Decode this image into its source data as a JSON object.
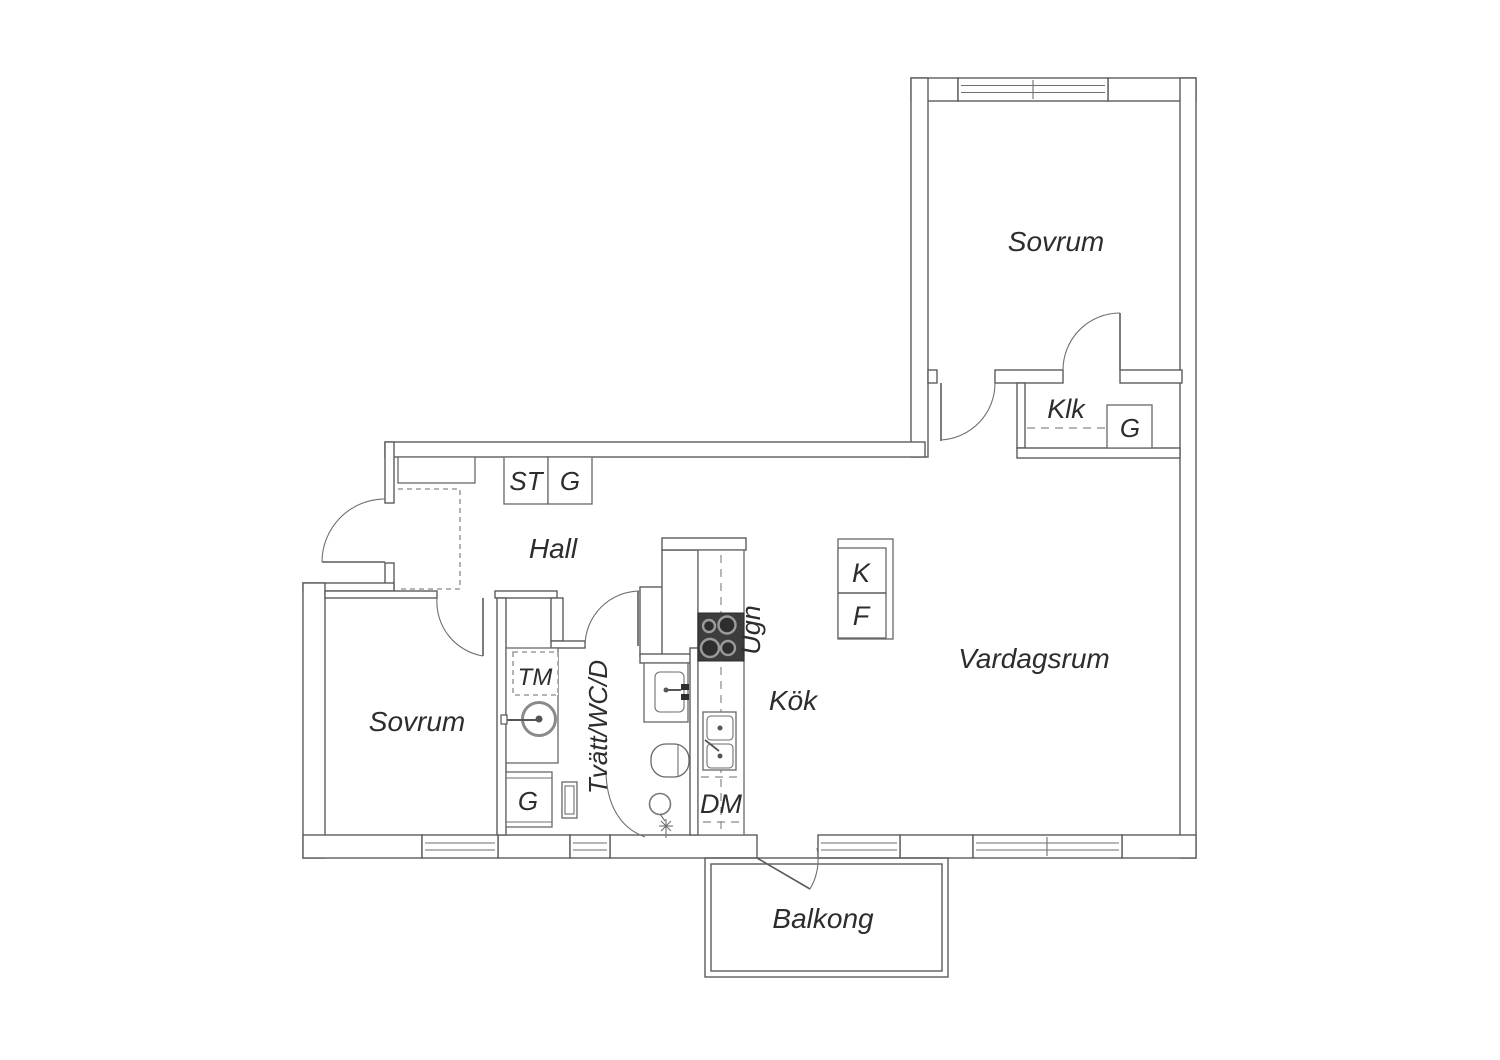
{
  "plan": {
    "rooms": {
      "bedroom_right": "Sovrum",
      "bedroom_left": "Sovrum",
      "hall": "Hall",
      "walk_in_closet": "Klk",
      "kitchen": "Kök",
      "living_room": "Vardagsrum",
      "bathroom": "Tvätt/WC/D",
      "balcony": "Balkong"
    },
    "fixtures": {
      "oven": "Ugn",
      "dishwasher": "DM",
      "washing_machine": "TM",
      "fridge": "K",
      "freezer": "F",
      "cleaning_closet": "ST",
      "wardrobe_hall": "G",
      "wardrobe_walk_in": "G",
      "wardrobe_bathroom": "G"
    },
    "colors": {
      "background": "#ffffff",
      "wall_line": "#5c5c5c",
      "text": "#2d2d2d",
      "stove_body": "#3d3d3d",
      "burner_ring": "#9b9b9b"
    }
  }
}
